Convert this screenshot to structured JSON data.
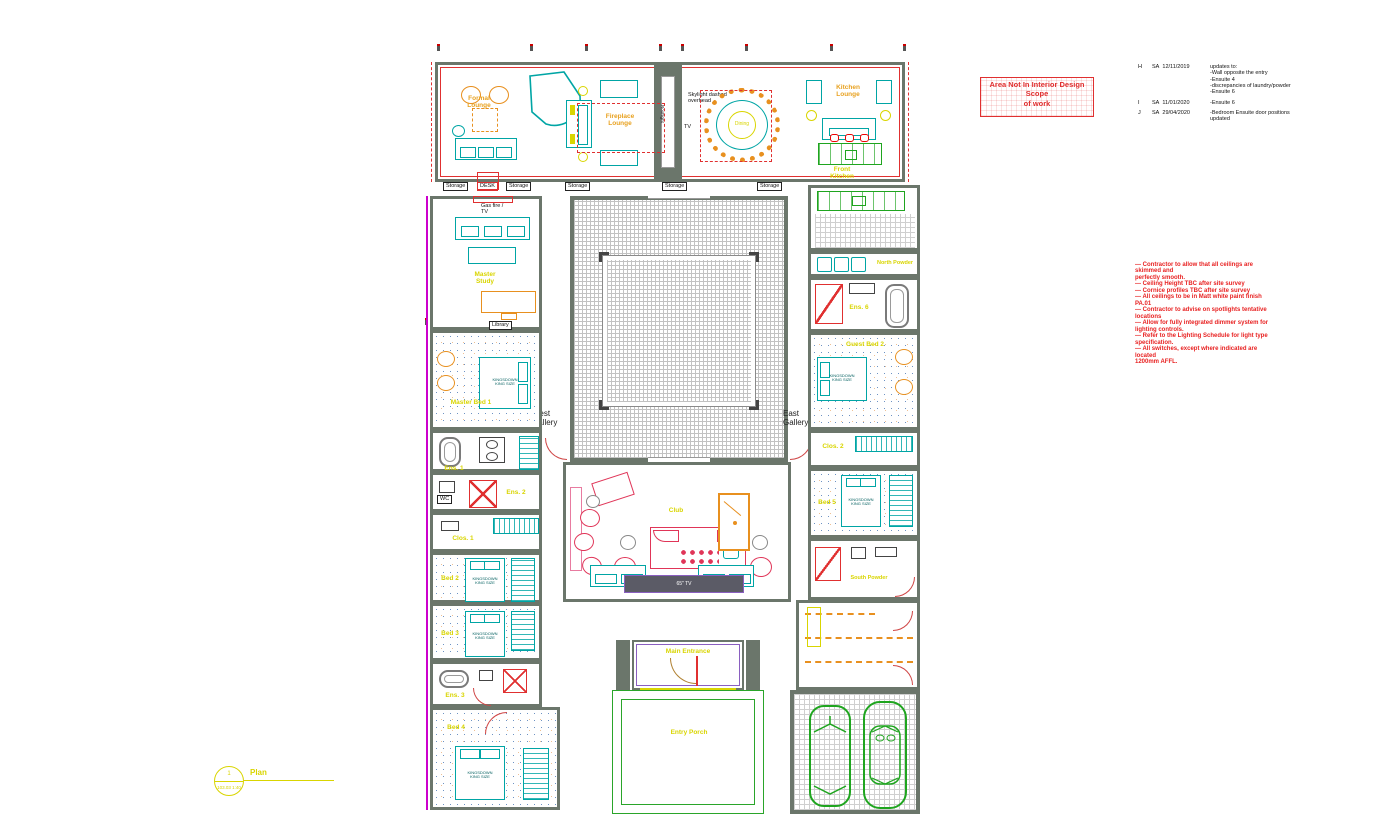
{
  "colors": {
    "wall": "#6b766b",
    "cad_yellow": "#d9d500",
    "annotation_red": "#e82222",
    "scope_red": "#e03030",
    "furniture_teal": "#00a5a5",
    "furniture_orange": "#e8901f",
    "kitchen_green": "#1fa51f",
    "club_red": "#e03558",
    "entry_purple": "#8a5fc0",
    "edge_magenta": "#cc00cc"
  },
  "scope_box": {
    "text": "Area Not In Interior Design\nScope\nof work"
  },
  "revisions": [
    {
      "rev": "H",
      "by": "SA",
      "date": "12/11/2019",
      "desc": "updates to:\n-Wall opposite the entry\n-Ensuite 4\n-discrepancies of laundry/powder\n-Ensuite 6"
    },
    {
      "rev": "I",
      "by": "SA",
      "date": "11/01/2020",
      "desc": "-Ensuite 6"
    },
    {
      "rev": "J",
      "by": "SA",
      "date": "29/04/2020",
      "desc": "-Bedroom Ensuite door positions\nupdated"
    }
  ],
  "notes": {
    "text": "—  Contractor  to  allow  that  all  ceilings  are\nskimmed and\n     perfectly smooth.\n—  Ceiling Height TBC after site survey\n—  Cornice profiles TBC after site survey\n—  All ceilings to be in Matt white paint finish\nPA.01\n—  Contractor to advise on spotlights tentative\nlocations\n—  Allow for fully integrated dimmer system for\nlighting controls.\n—  Refer to the Lighting Schedule for light type\nspecification.\n—  All switches, except where indicated are\nlocated\n     1200mm AFFL."
  },
  "galleries": {
    "west": "West\nGallery",
    "east": "East\nGallery"
  },
  "title_mark": {
    "number": "1",
    "ref": "103.03  1:40",
    "label": "Plan"
  },
  "labels": {
    "storage": "Storage",
    "desk": "DESK",
    "skylight": "Skylight dashed\noverhead",
    "tv": "TV",
    "roof_light": "Rooflight",
    "gas_fire": "Gas fire /\nTV",
    "library": "Library",
    "tv65": "65\" TV",
    "bed_tag": "KINGSDOWN\nKING SIZE"
  },
  "rooms": {
    "formal_lounge": "Formal\nLounge",
    "fireplace_lounge": "Fireplace\nLounge",
    "dining": "Dining",
    "kitchen_lounge": "Kitchen\nLounge",
    "front_kitchen": "Front\nKitchen",
    "master_study": "Master\nStudy",
    "master_bed": "Master Bed 1",
    "ens1": "Ens. 1",
    "ens2": "Ens. 2",
    "clos1": "Clos. 1",
    "bed2": "Bed 2",
    "bed3": "Bed 3",
    "ens3": "Ens. 3",
    "bed4": "Bed 4",
    "north_powder": "North Powder",
    "ens6": "Ens. 6",
    "guest_bed2": "Guest Bed 2",
    "clos2": "Clos. 2",
    "bed5": "Bed 5",
    "south_powder": "South Powder",
    "club": "Club",
    "main_entrance": "Main Entrance",
    "entry_porch": "Entry Porch"
  }
}
